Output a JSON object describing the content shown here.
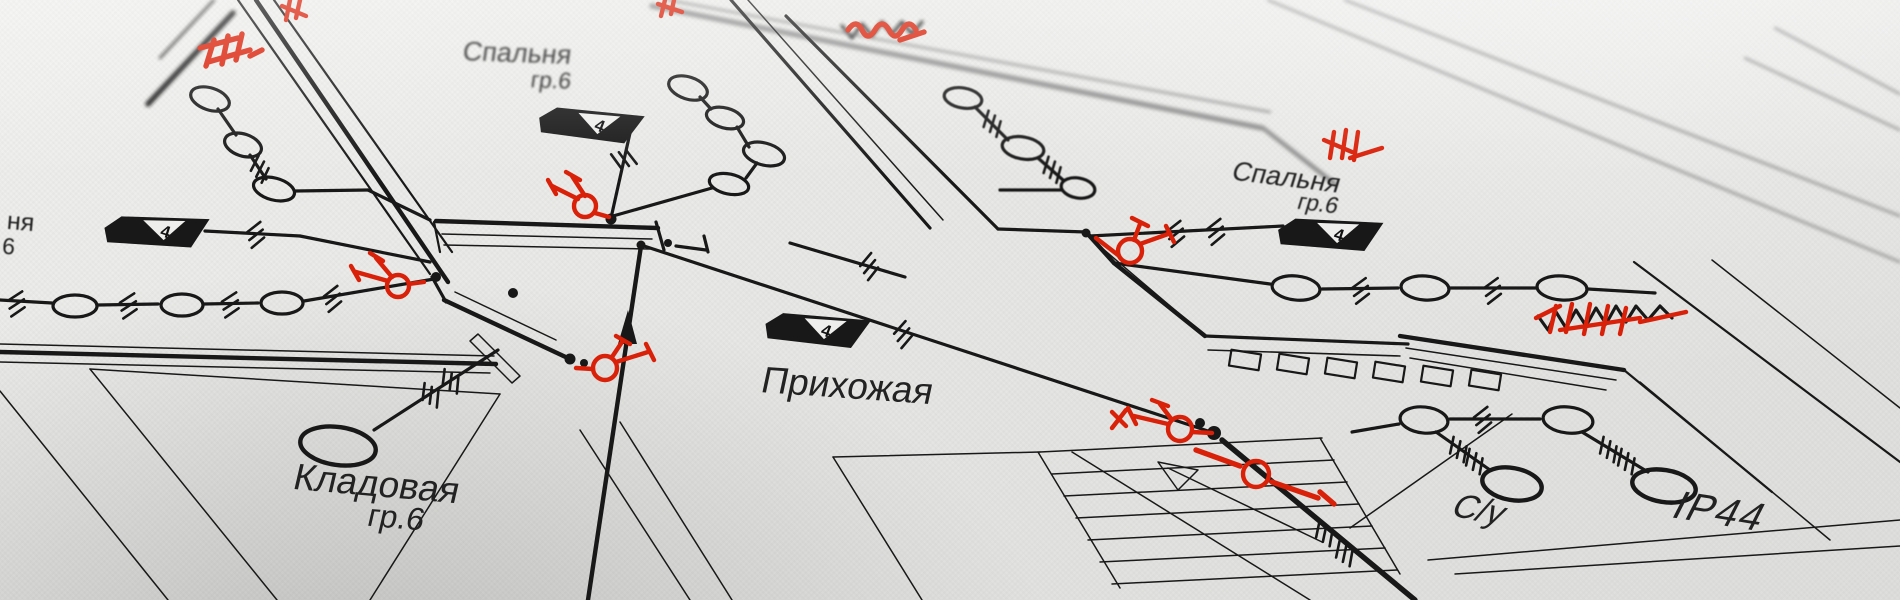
{
  "document": {
    "kind": "Electrical wiring floor plan (photo of drawing)",
    "language": "ru"
  },
  "rooms": {
    "bedroom_top_left": {
      "name": "Спальня",
      "group": "гр.6"
    },
    "bedroom_right": {
      "name": "Спальня",
      "group": "гр.6"
    },
    "hallway": {
      "name": "Прихожая"
    },
    "storage": {
      "name": "Кладовая",
      "group": "гр.6"
    },
    "bathroom": {
      "name": "С/у"
    },
    "bathroom_rating": {
      "name": "IP44"
    },
    "clipped_left": {
      "line1": "ня",
      "line2": "6"
    }
  },
  "symbols": {
    "panel_flag_value": "4",
    "marker_icons": [
      "chandelier-marker-icon",
      "wire-redline-marker-icon",
      "scribble-marker-icon"
    ],
    "plan_icons": [
      "lamp-oval-icon",
      "distribution-flag-icon",
      "stairs-icon",
      "cable-hatch-icon"
    ]
  },
  "colors": {
    "paper": "#e9e9e7",
    "ink": "#181818",
    "soft_ink": "#8b8b8b",
    "marker_red": "#d92008"
  }
}
